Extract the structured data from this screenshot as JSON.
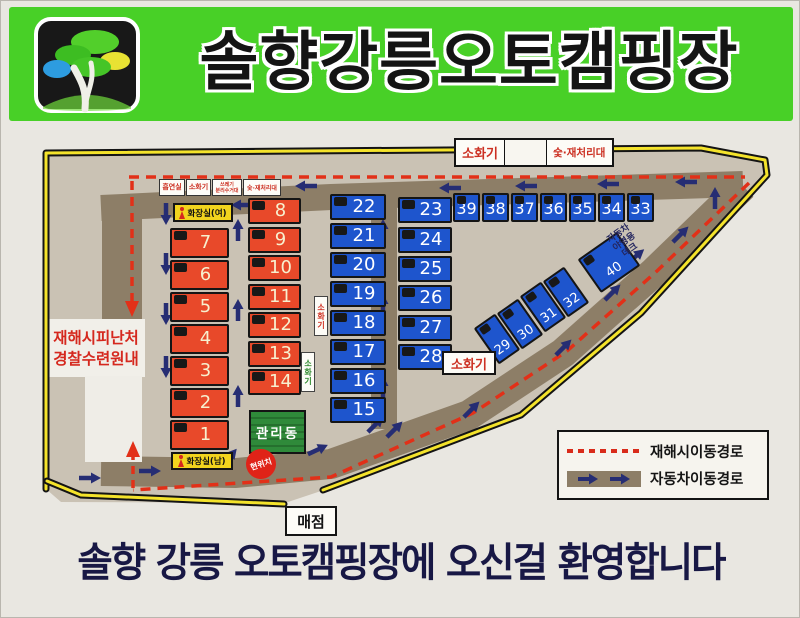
{
  "header": {
    "title": "솔향강릉오토캠핑장"
  },
  "welcome": "솔향 강릉 오토캠핑장에 오신걸 환영합니다",
  "legend": {
    "evac": "재해시이동경로",
    "car": "자동차이동경로"
  },
  "labels": {
    "smoking": "흡연실",
    "fire_small": "소화기",
    "recycle_1": "쓰레기",
    "recycle_2": "분리수거대",
    "charcoal_small": "숯·재처리대",
    "toilet_f": "화장실(여)",
    "toilet_m": "화장실(남)",
    "shelter_1": "재해시피난처",
    "shelter_2": "경찰수련원내",
    "mgmt": "관리동",
    "cur_loc": "현위치",
    "store": "매점",
    "fire_top": "소화기",
    "charcoal_top": "숯·재처리대",
    "fire_right": "소화기",
    "fire_v1": "소화기",
    "fire_v2": "소화기",
    "deck_1": "자동차",
    "deck_2": "야영용",
    "deck_3": "데크"
  },
  "colors": {
    "banner_green": "#48d027",
    "site_red": "#e8492a",
    "site_blue": "#1e55cd",
    "road_brown": "#8d7e67",
    "map_ground": "#cac2b4",
    "boundary_yellow": "#f4e32b",
    "evac_red": "#e23018",
    "arrow_navy": "#262d73"
  },
  "map": {
    "sites": [
      {
        "n": 1,
        "t": "col",
        "c": "r",
        "x": 169,
        "y": 419,
        "w": 59,
        "h": 30
      },
      {
        "n": 2,
        "t": "col",
        "c": "r",
        "x": 169,
        "y": 387,
        "w": 59,
        "h": 30
      },
      {
        "n": 3,
        "t": "col",
        "c": "r",
        "x": 169,
        "y": 355,
        "w": 59,
        "h": 30
      },
      {
        "n": 4,
        "t": "col",
        "c": "r",
        "x": 169,
        "y": 323,
        "w": 59,
        "h": 30
      },
      {
        "n": 5,
        "t": "col",
        "c": "r",
        "x": 169,
        "y": 291,
        "w": 59,
        "h": 30
      },
      {
        "n": 6,
        "t": "col",
        "c": "r",
        "x": 169,
        "y": 259,
        "w": 59,
        "h": 30
      },
      {
        "n": 7,
        "t": "col",
        "c": "r",
        "x": 169,
        "y": 227,
        "w": 59,
        "h": 30
      },
      {
        "n": 8,
        "t": "col",
        "c": "r",
        "x": 247,
        "y": 197,
        "w": 53,
        "h": 26
      },
      {
        "n": 9,
        "t": "col",
        "c": "r",
        "x": 247,
        "y": 226,
        "w": 53,
        "h": 26
      },
      {
        "n": 10,
        "t": "col",
        "c": "r",
        "x": 247,
        "y": 254,
        "w": 53,
        "h": 26
      },
      {
        "n": 11,
        "t": "col",
        "c": "r",
        "x": 247,
        "y": 283,
        "w": 53,
        "h": 26
      },
      {
        "n": 12,
        "t": "col",
        "c": "r",
        "x": 247,
        "y": 311,
        "w": 53,
        "h": 26
      },
      {
        "n": 13,
        "t": "col",
        "c": "r",
        "x": 247,
        "y": 340,
        "w": 53,
        "h": 26
      },
      {
        "n": 14,
        "t": "col",
        "c": "r",
        "x": 247,
        "y": 368,
        "w": 53,
        "h": 26
      },
      {
        "n": 15,
        "t": "col",
        "c": "b",
        "x": 329,
        "y": 396,
        "w": 56,
        "h": 26
      },
      {
        "n": 16,
        "t": "col",
        "c": "b",
        "x": 329,
        "y": 367,
        "w": 56,
        "h": 26
      },
      {
        "n": 17,
        "t": "col",
        "c": "b",
        "x": 329,
        "y": 338,
        "w": 56,
        "h": 26
      },
      {
        "n": 18,
        "t": "col",
        "c": "b",
        "x": 329,
        "y": 309,
        "w": 56,
        "h": 26
      },
      {
        "n": 19,
        "t": "col",
        "c": "b",
        "x": 329,
        "y": 280,
        "w": 56,
        "h": 26
      },
      {
        "n": 20,
        "t": "col",
        "c": "b",
        "x": 329,
        "y": 251,
        "w": 56,
        "h": 26
      },
      {
        "n": 21,
        "t": "col",
        "c": "b",
        "x": 329,
        "y": 222,
        "w": 56,
        "h": 26
      },
      {
        "n": 22,
        "t": "col",
        "c": "b",
        "x": 329,
        "y": 193,
        "w": 56,
        "h": 26
      },
      {
        "n": 23,
        "t": "col",
        "c": "b",
        "x": 397,
        "y": 196,
        "w": 54,
        "h": 26
      },
      {
        "n": 24,
        "t": "col",
        "c": "b",
        "x": 397,
        "y": 226,
        "w": 54,
        "h": 26
      },
      {
        "n": 25,
        "t": "col",
        "c": "b",
        "x": 397,
        "y": 255,
        "w": 54,
        "h": 26
      },
      {
        "n": 26,
        "t": "col",
        "c": "b",
        "x": 397,
        "y": 284,
        "w": 54,
        "h": 26
      },
      {
        "n": 27,
        "t": "col",
        "c": "b",
        "x": 397,
        "y": 314,
        "w": 54,
        "h": 26
      },
      {
        "n": 28,
        "t": "col",
        "c": "b",
        "x": 397,
        "y": 343,
        "w": 54,
        "h": 26
      },
      {
        "n": 29,
        "t": "rot",
        "c": "b",
        "x": 483,
        "y": 316,
        "w": 26,
        "h": 44,
        "r": -35
      },
      {
        "n": 30,
        "t": "rot",
        "c": "b",
        "x": 506,
        "y": 301,
        "w": 26,
        "h": 44,
        "r": -35
      },
      {
        "n": 31,
        "t": "rot",
        "c": "b",
        "x": 529,
        "y": 284,
        "w": 26,
        "h": 44,
        "r": -35
      },
      {
        "n": 32,
        "t": "rot",
        "c": "b",
        "x": 552,
        "y": 269,
        "w": 26,
        "h": 44,
        "r": -35
      },
      {
        "n": 33,
        "t": "row",
        "c": "b",
        "x": 626,
        "y": 192,
        "w": 27,
        "h": 29
      },
      {
        "n": 34,
        "t": "row",
        "c": "b",
        "x": 597,
        "y": 192,
        "w": 27,
        "h": 29
      },
      {
        "n": 35,
        "t": "row",
        "c": "b",
        "x": 568,
        "y": 192,
        "w": 27,
        "h": 29
      },
      {
        "n": 36,
        "t": "row",
        "c": "b",
        "x": 539,
        "y": 192,
        "w": 27,
        "h": 29
      },
      {
        "n": 37,
        "t": "row",
        "c": "b",
        "x": 510,
        "y": 192,
        "w": 27,
        "h": 29
      },
      {
        "n": 38,
        "t": "row",
        "c": "b",
        "x": 481,
        "y": 192,
        "w": 27,
        "h": 29
      },
      {
        "n": 39,
        "t": "row",
        "c": "b",
        "x": 452,
        "y": 192,
        "w": 27,
        "h": 29
      },
      {
        "n": 40,
        "t": "rot",
        "c": "b",
        "x": 584,
        "y": 241,
        "w": 48,
        "h": 41,
        "r": -35
      }
    ],
    "arrows": [
      [
        165,
        212,
        90
      ],
      [
        165,
        262,
        90
      ],
      [
        165,
        312,
        90
      ],
      [
        165,
        365,
        90
      ],
      [
        237,
        230,
        -90
      ],
      [
        237,
        310,
        -90
      ],
      [
        237,
        396,
        -90
      ],
      [
        242,
        204,
        180
      ],
      [
        306,
        185,
        180
      ],
      [
        450,
        187,
        180
      ],
      [
        526,
        185,
        180
      ],
      [
        608,
        183,
        180
      ],
      [
        686,
        181,
        180
      ],
      [
        382,
        230,
        -90
      ],
      [
        382,
        305,
        -90
      ],
      [
        382,
        387,
        -90
      ],
      [
        714,
        198,
        -90
      ],
      [
        679,
        234,
        -45
      ],
      [
        611,
        292,
        -45
      ],
      [
        562,
        347,
        -45
      ],
      [
        88,
        477,
        0
      ],
      [
        148,
        470,
        0
      ],
      [
        228,
        457,
        -50
      ],
      [
        316,
        449,
        -25
      ],
      [
        374,
        424,
        -45
      ],
      [
        393,
        429,
        -45
      ],
      [
        470,
        409,
        -45
      ],
      [
        634,
        256,
        -40
      ]
    ]
  }
}
